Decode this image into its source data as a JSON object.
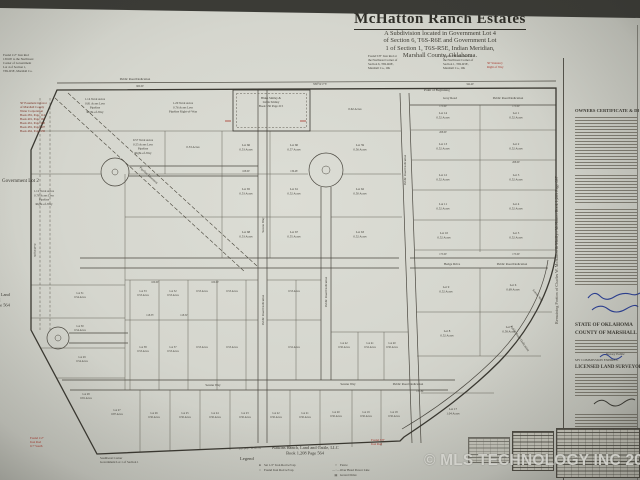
{
  "meta": {
    "watermark": "© MLS TECHNOLOGY INC 2026"
  },
  "title": {
    "name": "McHatton Ranch Estates",
    "subtitle_lines": [
      "A Subdivision located in Government Lot 4",
      "of Section 6, T6S-R6E and Government Lot",
      "1 of Section 1, T6S-R5E, Indian Meridian,",
      "Marshall County, Oklahoma."
    ]
  },
  "sidebar": {
    "vertical_note": "Remaining Portion of Charles W. McHatton & Marilyn McHatton    Book 1,263 Page 697",
    "owners_heading": "OWNERS CERTIFICATE & DEDICATION",
    "state_lines": [
      "STATE OF OKLAHOMA",
      "COUNTY OF MARSHALL"
    ],
    "notary_label": "Notary Public",
    "commission_label": "MY COMMISSION EXPIRES:",
    "surveyor_heading": "LICENSED LAND SURVEYOR"
  },
  "footer": {
    "legend_title": "Legend",
    "legend_col1": [
      {
        "sym": "●",
        "label": "Set 1/2\" Iron Rod w/Cap"
      },
      {
        "sym": "○",
        "label": "Found Iron Rod w/Cap"
      }
    ],
    "legend_col2": [
      {
        "sym": "×",
        "label": "Fence"
      },
      {
        "sym": "—·—",
        "label": "Over Head Power Line"
      },
      {
        "sym": "▤",
        "label": "Gravel Drive"
      }
    ]
  },
  "map": {
    "pipeline_label": "Pipeline Easement",
    "road_labels": [
      {
        "t": "Public Road Dedication",
        "x": 135,
        "y": 80
      },
      {
        "t": "Gray Road",
        "x": 450,
        "y": 99
      },
      {
        "t": "Public Road Dedication",
        "x": 508,
        "y": 99
      },
      {
        "t": "Hedge Drive",
        "x": 452,
        "y": 265
      },
      {
        "t": "Public Road Dedication",
        "x": 512,
        "y": 265
      },
      {
        "t": "Serene Way",
        "x": 213,
        "y": 386
      },
      {
        "t": "Serene Way",
        "x": 348,
        "y": 385
      },
      {
        "t": "Public Road Dedication",
        "x": 408,
        "y": 385
      },
      {
        "t": "Serene Way",
        "x": 264,
        "y": 225,
        "r": -90
      },
      {
        "t": "Public Road Dedication",
        "x": 264,
        "y": 310,
        "r": -90
      },
      {
        "t": "Public Road Dedication",
        "x": 327,
        "y": 292,
        "r": -90
      },
      {
        "t": "Public Road Dedication",
        "x": 406,
        "y": 170,
        "r": -90
      },
      {
        "t": "Scenic Way",
        "x": 537,
        "y": 296,
        "r": 52
      },
      {
        "t": "Public Road Dedication",
        "x": 519,
        "y": 339,
        "r": 55
      },
      {
        "t": "Pipeline Easement",
        "x": 148,
        "y": 176,
        "r": 43
      }
    ],
    "lots": [
      {
        "x": 95,
        "y": 100,
        "lines": [
          "1.14 Total Acres",
          "0.81 Acres Less",
          "Pipeline",
          "Right-of-Way"
        ]
      },
      {
        "x": 183,
        "y": 104,
        "lines": [
          "1.20 Total Acres",
          "0.76 Acres Less",
          "Pipeline Right-of-Way"
        ]
      },
      {
        "x": 143,
        "y": 141,
        "lines": [
          "0.57 Total Acres",
          "0.55 Acres Less",
          "Pipeline",
          "Right-of-Way"
        ]
      },
      {
        "x": 193,
        "y": 148,
        "lines": [
          "0.53 Acres"
        ]
      },
      {
        "x": 44,
        "y": 192,
        "lines": [
          "1.12 Total Acres",
          "0.78 Acres Less",
          "Pipeline",
          "Right-of-Way"
        ]
      },
      {
        "x": 355,
        "y": 110,
        "lines": [
          "0.62 Acres"
        ]
      },
      {
        "x": 246,
        "y": 146,
        "lines": [
          "Lot 66",
          "0.53 Acres"
        ]
      },
      {
        "x": 294,
        "y": 146,
        "lines": [
          "Lot 60",
          "0.57 Acres"
        ]
      },
      {
        "x": 360,
        "y": 146,
        "lines": [
          "Lot 59",
          "0.56 Acres"
        ]
      },
      {
        "x": 246,
        "y": 190,
        "lines": [
          "Lot 65",
          "0.53 Acres"
        ]
      },
      {
        "x": 294,
        "y": 190,
        "lines": [
          "Lot 61",
          "0.52 Acres"
        ]
      },
      {
        "x": 360,
        "y": 190,
        "lines": [
          "Lot 62",
          "0.50 Acres"
        ]
      },
      {
        "x": 246,
        "y": 233,
        "lines": [
          "Lot 68",
          "0.53 Acres"
        ]
      },
      {
        "x": 294,
        "y": 233,
        "lines": [
          "Lot 67",
          "0.55 Acres"
        ]
      },
      {
        "x": 360,
        "y": 233,
        "lines": [
          "Lot 63",
          "0.52 Acres"
        ]
      },
      {
        "x": 443,
        "y": 114,
        "lines": [
          "Lot 14",
          "0.52 Acres"
        ]
      },
      {
        "x": 516,
        "y": 114,
        "lines": [
          "Lot 1",
          "0.52 Acres"
        ]
      },
      {
        "x": 443,
        "y": 145,
        "lines": [
          "Lot 13",
          "0.52 Acres"
        ]
      },
      {
        "x": 516,
        "y": 145,
        "lines": [
          "Lot 2",
          "0.52 Acres"
        ]
      },
      {
        "x": 443,
        "y": 176,
        "lines": [
          "Lot 12",
          "0.52 Acres"
        ]
      },
      {
        "x": 516,
        "y": 176,
        "lines": [
          "Lot 3",
          "0.52 Acres"
        ]
      },
      {
        "x": 443,
        "y": 205,
        "lines": [
          "Lot 11",
          "0.52 Acres"
        ]
      },
      {
        "x": 516,
        "y": 205,
        "lines": [
          "Lot 4",
          "0.52 Acres"
        ]
      },
      {
        "x": 444,
        "y": 234,
        "lines": [
          "Lot 10",
          "0.52 Acres"
        ]
      },
      {
        "x": 516,
        "y": 234,
        "lines": [
          "Lot 5",
          "0.52 Acres"
        ]
      },
      {
        "x": 446,
        "y": 288,
        "lines": [
          "Lot 9",
          "0.52 Acres"
        ]
      },
      {
        "x": 513,
        "y": 286,
        "lines": [
          "Lot 6",
          "0.69 Acres"
        ]
      },
      {
        "x": 447,
        "y": 332,
        "lines": [
          "Lot 8",
          "0.52 Acres"
        ]
      },
      {
        "x": 509,
        "y": 328,
        "lines": [
          "Lot 7",
          "0.58 Acres"
        ]
      },
      {
        "x": 143,
        "y": 292,
        "lines": [
          "Lot 53",
          "0.53 Acres"
        ],
        "fs": 2.7
      },
      {
        "x": 173,
        "y": 292,
        "lines": [
          "Lot 52",
          "0.53 Acres"
        ],
        "fs": 2.7
      },
      {
        "x": 202,
        "y": 292,
        "lines": [
          "0.53 Acres"
        ],
        "fs": 2.7
      },
      {
        "x": 232,
        "y": 292,
        "lines": [
          "0.53 Acres"
        ],
        "fs": 2.7
      },
      {
        "x": 143,
        "y": 348,
        "lines": [
          "Lot 38",
          "0.53 Acres"
        ],
        "fs": 2.7
      },
      {
        "x": 173,
        "y": 348,
        "lines": [
          "Lot 37",
          "0.53 Acres"
        ],
        "fs": 2.7
      },
      {
        "x": 202,
        "y": 348,
        "lines": [
          "0.53 Acres"
        ],
        "fs": 2.7
      },
      {
        "x": 232,
        "y": 348,
        "lines": [
          "0.53 Acres"
        ],
        "fs": 2.7
      },
      {
        "x": 294,
        "y": 292,
        "lines": [
          "0.53 Acres"
        ],
        "fs": 2.7
      },
      {
        "x": 294,
        "y": 348,
        "lines": [
          "0.52 Acres"
        ],
        "fs": 2.7
      },
      {
        "x": 344,
        "y": 344,
        "lines": [
          "Lot 42",
          "0.50 Acres"
        ],
        "fs": 2.7
      },
      {
        "x": 370,
        "y": 344,
        "lines": [
          "Lot 41",
          "0.52 Acres"
        ],
        "fs": 2.7
      },
      {
        "x": 392,
        "y": 344,
        "lines": [
          "Lot 40",
          "0.50 Acres"
        ],
        "fs": 2.7
      },
      {
        "x": 80,
        "y": 294,
        "lines": [
          "Lot 31",
          "0.54 Acres"
        ],
        "fs": 2.7
      },
      {
        "x": 80,
        "y": 327,
        "lines": [
          "Lot 30",
          "0.54 Acres"
        ],
        "fs": 2.7
      },
      {
        "x": 82,
        "y": 358,
        "lines": [
          "Lot 29",
          "0.54 Acres"
        ],
        "fs": 2.7
      },
      {
        "x": 86,
        "y": 395,
        "lines": [
          "Lot 28",
          "0.81 Acres"
        ],
        "fs": 2.7
      },
      {
        "x": 117,
        "y": 411,
        "lines": [
          "Lot 27",
          "0.87 Acres"
        ],
        "fs": 2.7
      },
      {
        "x": 154,
        "y": 414,
        "lines": [
          "Lot 26",
          "0.50 Acres"
        ],
        "fs": 2.7
      },
      {
        "x": 185,
        "y": 414,
        "lines": [
          "Lot 25",
          "0.50 Acres"
        ],
        "fs": 2.7
      },
      {
        "x": 215,
        "y": 414,
        "lines": [
          "Lot 24",
          "0.50 Acres"
        ],
        "fs": 2.7
      },
      {
        "x": 245,
        "y": 414,
        "lines": [
          "Lot 23",
          "0.50 Acres"
        ],
        "fs": 2.7
      },
      {
        "x": 276,
        "y": 414,
        "lines": [
          "Lot 22",
          "0.50 Acres"
        ],
        "fs": 2.7
      },
      {
        "x": 305,
        "y": 414,
        "lines": [
          "Lot 21",
          "0.50 Acres"
        ],
        "fs": 2.7
      },
      {
        "x": 336,
        "y": 413,
        "lines": [
          "Lot 20",
          "0.50 Acres"
        ],
        "fs": 2.7
      },
      {
        "x": 366,
        "y": 413,
        "lines": [
          "Lot 19",
          "0.50 Acres"
        ],
        "fs": 2.7
      },
      {
        "x": 394,
        "y": 413,
        "lines": [
          "Lot 18",
          "0.50 Acres"
        ],
        "fs": 2.7
      },
      {
        "x": 453,
        "y": 410,
        "lines": [
          "Lot 17",
          "1.04 Acres"
        ]
      }
    ],
    "dims": [
      {
        "t": "175.00'",
        "x": 443,
        "y": 107
      },
      {
        "t": "175.00'",
        "x": 516,
        "y": 107
      },
      {
        "t": "208.00'",
        "x": 443,
        "y": 133
      },
      {
        "t": "208.00'",
        "x": 516,
        "y": 163
      },
      {
        "t": "136.48'",
        "x": 294,
        "y": 172
      },
      {
        "t": "108.00'",
        "x": 246,
        "y": 172
      },
      {
        "t": "118.35'",
        "x": 150,
        "y": 316
      },
      {
        "t": "118.32'",
        "x": 184,
        "y": 316
      },
      {
        "t": "131.84'",
        "x": 420,
        "y": 392
      },
      {
        "t": "660.00'",
        "x": 140,
        "y": 87
      },
      {
        "t": "342.40'",
        "x": 470,
        "y": 85
      },
      {
        "t": "N89°54'17\"E",
        "x": 320,
        "y": 85
      },
      {
        "t": "S89°54'37\"W  931.04'",
        "x": 250,
        "y": 449,
        "r": -2
      },
      {
        "t": "N0°05'43\"W",
        "x": 36,
        "y": 250,
        "r": -90
      },
      {
        "t": "175.00'",
        "x": 443,
        "y": 255
      },
      {
        "t": "175.00'",
        "x": 516,
        "y": 255
      },
      {
        "t": "100.00'",
        "x": 155,
        "y": 283
      },
      {
        "t": "100.00'",
        "x": 215,
        "y": 283
      }
    ],
    "notes": [
      {
        "x": 3,
        "y": 56,
        "lines": [
          "Found 1/2\" Iron Rod",
          "130.66' to the Northwest",
          "Corner of Government",
          "Lot 4 of Section 1,",
          "T6S-R5E, Marshall Co."
        ]
      },
      {
        "x": 368,
        "y": 57,
        "lines": [
          "Found 5/8\" Iron Rod at",
          "the Northeast Corner of",
          "Section 6, T6S-R6E,",
          "Marshall Co., OK"
        ]
      },
      {
        "x": 443,
        "y": 57,
        "lines": [
          "Found 5/8\" Iron Rod at",
          "the Northwest Corner of",
          "Section 1, T6S-R5E,",
          "Marshall Co., OK"
        ]
      },
      {
        "x": 20,
        "y": 104,
        "lines": [
          "50' Easement in favor",
          "of Marshall County",
          "Water Corporation",
          "Book 281, Page 114",
          "Book 401, Page 162",
          "Book 461, Page 490",
          "Book 481, Page 607",
          "Book 462, Page 980"
        ],
        "c": "maroon"
      },
      {
        "x": 487,
        "y": 64,
        "lines": [
          "50' Statutory",
          "Right of Way"
        ],
        "c": "red"
      },
      {
        "x": 30,
        "y": 439,
        "lines": [
          "Found 1/2\"",
          "Iron Rod",
          "0.7' South"
        ],
        "c": "red"
      },
      {
        "x": 371,
        "y": 441,
        "lines": [
          "Found 3/8\"",
          "Iron Rod"
        ],
        "c": "red"
      },
      {
        "x": 100,
        "y": 459,
        "lines": [
          "Southwest Corner",
          "Government Lot 1 of Section 1"
        ]
      },
      {
        "x": -28,
        "y": 296,
        "lines": [
          "Watkins Ranch, Land",
          "and Cattle, LLC",
          "Book 1,208 Page 564"
        ],
        "fs": 4.4
      },
      {
        "x": 2,
        "y": 182,
        "lines": [
          "Government Lot 2"
        ],
        "fs": 5
      },
      {
        "x": 271,
        "y": 99,
        "lines": [
          "Blake Smiley &",
          "Linda Smiley",
          "Book 536  Page 215"
        ],
        "a": "middle"
      },
      {
        "x": 424,
        "y": 91,
        "lines": [
          "Point of Beginning"
        ],
        "fs": 3.4
      },
      {
        "x": 305,
        "y": 449,
        "lines": [
          "Watkins Ranch, Land and Cattle, LLC",
          "Book 1,208 Page 564"
        ],
        "a": "middle",
        "fs": 4.4
      }
    ]
  },
  "colors": {
    "ink": "#3c3a33",
    "red": "#a8352a",
    "maroon": "#7a2d20",
    "blue": "#2b3f94"
  }
}
